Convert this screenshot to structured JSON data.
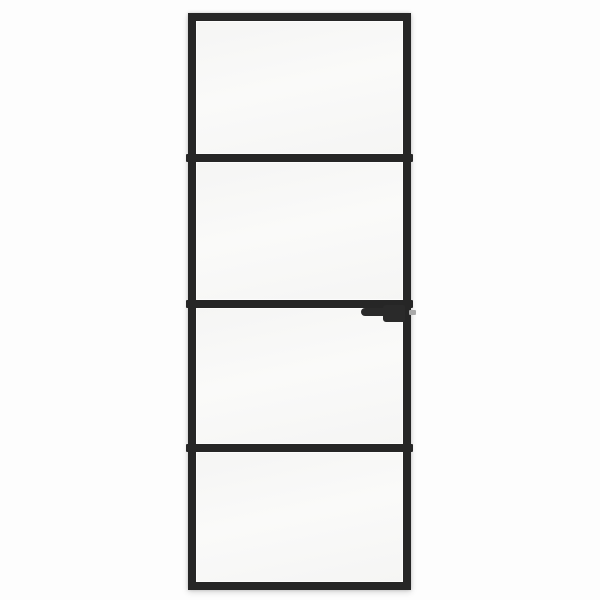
{
  "image": {
    "description": "Product photo of a slim black-framed interior glass door with four light glass panels, three horizontal divider bars, and a black lever handle on the right side below the middle bar",
    "panel_count": 4,
    "divider_count": 3,
    "handle_side": "right",
    "handle_style": "lever pointing left"
  },
  "colors": {
    "background": "#fdfdfd",
    "frame": "#262626",
    "glass": "#f5f5f4",
    "glass_light": "#fafaf9",
    "handle": "#2a2a2a",
    "latch": "#a9a9a9",
    "halo": "rgba(0,0,0,0.16)"
  }
}
